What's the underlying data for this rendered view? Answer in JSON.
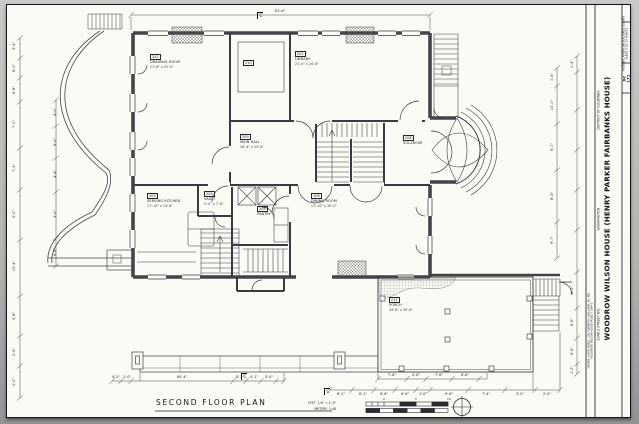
{
  "sheet": {
    "plan_title": "SECOND FLOOR PLAN",
    "scale": {
      "feet_label": "FEET",
      "feet_ratio": "1/4\" = 1'-0\"",
      "meters_label": "METERS",
      "meters_ratio": "1:48",
      "feet_ticks": [
        "0",
        "5",
        "10"
      ]
    },
    "title_block": {
      "survey_heading": "HISTORIC AMERICAN BUILDINGS SURVEY",
      "sheet_note": "SHEET 5 OF 13 SHEETS",
      "survey_no_state": "DC",
      "survey_no": "171",
      "title": "WOODROW WILSON HOUSE (HENRY PARKER FAIRBANKS HOUSE)",
      "address": "2340 S STREET NW",
      "city": "WASHINGTON",
      "state": "DISTRICT OF COLUMBIA",
      "credit_line": "DRAWN: LAFFE ARNELL, CRS, KENNETH L WILLIAMS, RA, MJV",
      "project_line": "WOODROW WILSON HOUSE PROJECT 1984-5"
    }
  },
  "plan": {
    "rooms": [
      {
        "num": "202",
        "name": "DRAWING ROOM",
        "dims": "21'-6\" x 25'-0\"",
        "x": 150,
        "y": 54
      },
      {
        "num": "210",
        "name": "",
        "dims": "",
        "x": 243,
        "y": 60
      },
      {
        "num": "201",
        "name": "LIBRARY",
        "dims": "21'-0\" x 24'-6\"",
        "x": 295,
        "y": 51
      },
      {
        "num": "209",
        "name": "MAIN HALL",
        "dims": "16'-4\" x 23'-6\"",
        "x": 240,
        "y": 134
      },
      {
        "num": "208",
        "name": "SOLARIUM",
        "dims": "",
        "x": 403,
        "y": 135
      },
      {
        "num": "203",
        "name": "SERVING KITCHEN",
        "dims": "17'-10\" x 13'-6\"",
        "x": 147,
        "y": 193
      },
      {
        "num": "204",
        "name": "VAULT",
        "dims": "5'-0\" x 7'-6\"",
        "x": 204,
        "y": 191
      },
      {
        "num": "205",
        "name": "PANTRY",
        "dims": "",
        "x": 257,
        "y": 206
      },
      {
        "num": "206",
        "name": "DINING ROOM",
        "dims": "17'-10\" x 30'-0\"",
        "x": 311,
        "y": 193
      },
      {
        "num": "211",
        "name": "PORCH",
        "dims": "34'-6\" x 30'-6\"",
        "x": 389,
        "y": 297
      }
    ],
    "dimensions": [
      {
        "t": "3'-4\"",
        "x": 14,
        "y": 46,
        "r": -90
      },
      {
        "t": "6'-0\"",
        "x": 14,
        "y": 68,
        "r": -90
      },
      {
        "t": "6'-8\"",
        "x": 14,
        "y": 90,
        "r": -90
      },
      {
        "t": "7'-0\"",
        "x": 14,
        "y": 124,
        "r": -90
      },
      {
        "t": "7'-4\"",
        "x": 14,
        "y": 168,
        "r": -90
      },
      {
        "t": "5'-0\"",
        "x": 14,
        "y": 214,
        "r": -90
      },
      {
        "t": "15'-4\"",
        "x": 14,
        "y": 266,
        "r": -90
      },
      {
        "t": "5'-8\"",
        "x": 14,
        "y": 316,
        "r": -90
      },
      {
        "t": "2'-6\"",
        "x": 14,
        "y": 352,
        "r": -90
      },
      {
        "t": "2'-0\"",
        "x": 14,
        "y": 382,
        "r": -90
      },
      {
        "t": "4'-0\"",
        "x": 55,
        "y": 112,
        "r": -90
      },
      {
        "t": "6'-0\"",
        "x": 55,
        "y": 142,
        "r": -90
      },
      {
        "t": "4'-4\"",
        "x": 55,
        "y": 174,
        "r": -90
      },
      {
        "t": "3'-0\"",
        "x": 55,
        "y": 214,
        "r": -90
      },
      {
        "t": "6'-8\"",
        "x": 55,
        "y": 252,
        "r": -90
      },
      {
        "t": "61'-6\"",
        "x": 280,
        "y": 11,
        "r": 0
      },
      {
        "t": "1'-6\"",
        "x": 552,
        "y": 77,
        "r": -90
      },
      {
        "t": "10'-0\"",
        "x": 552,
        "y": 105,
        "r": -90
      },
      {
        "t": "6'-7\"",
        "x": 552,
        "y": 147,
        "r": -90
      },
      {
        "t": "8'-3\"",
        "x": 552,
        "y": 196,
        "r": -90
      },
      {
        "t": "9'-7\"",
        "x": 552,
        "y": 240,
        "r": -90
      },
      {
        "t": "1'-4\"",
        "x": 572,
        "y": 64,
        "r": -90
      },
      {
        "t": "6'-0\"",
        "x": 572,
        "y": 290,
        "r": -90
      },
      {
        "t": "8'-6\"",
        "x": 572,
        "y": 322,
        "r": -90
      },
      {
        "t": "6'-6\"",
        "x": 572,
        "y": 351,
        "r": -90
      },
      {
        "t": "1'-0\"",
        "x": 572,
        "y": 370,
        "r": -90
      },
      {
        "t": "4'-2\"",
        "x": 116,
        "y": 377,
        "r": 0
      },
      {
        "t": "1'-0\"",
        "x": 127,
        "y": 377,
        "r": 0
      },
      {
        "t": "60'-4\"",
        "x": 182,
        "y": 377,
        "r": 0
      },
      {
        "t": "8'-1\"",
        "x": 240,
        "y": 377,
        "r": 0
      },
      {
        "t": "4'-1\"",
        "x": 254,
        "y": 377,
        "r": 0
      },
      {
        "t": "3'-4\"",
        "x": 269,
        "y": 377,
        "r": 0
      },
      {
        "t": "7'-6\"",
        "x": 392,
        "y": 375,
        "r": 0
      },
      {
        "t": "4'-8\"",
        "x": 416,
        "y": 375,
        "r": 0
      },
      {
        "t": "7'-6\"",
        "x": 439,
        "y": 375,
        "r": 0
      },
      {
        "t": "6'-8\"",
        "x": 465,
        "y": 375,
        "r": 0
      },
      {
        "t": "6'-2\"",
        "x": 341,
        "y": 394,
        "r": 0
      },
      {
        "t": "6'-1\"",
        "x": 363,
        "y": 394,
        "r": 0
      },
      {
        "t": "6'-6\"",
        "x": 384,
        "y": 394,
        "r": 0
      },
      {
        "t": "6'-6\"",
        "x": 405,
        "y": 394,
        "r": 0
      },
      {
        "t": "1'-0\"",
        "x": 423,
        "y": 394,
        "r": 0
      },
      {
        "t": "9'-6\"",
        "x": 449,
        "y": 394,
        "r": 0
      },
      {
        "t": "7'-4\"",
        "x": 486,
        "y": 394,
        "r": 0
      },
      {
        "t": "3'-0\"",
        "x": 520,
        "y": 394,
        "r": 0
      },
      {
        "t": "2'-0\"",
        "x": 547,
        "y": 394,
        "r": 0
      }
    ],
    "section_markers": [
      {
        "letter": "C",
        "x": 257,
        "y": 12
      },
      {
        "letter": "C",
        "x": 241,
        "y": 373
      },
      {
        "letter": "C",
        "x": 324,
        "y": 388
      }
    ]
  }
}
